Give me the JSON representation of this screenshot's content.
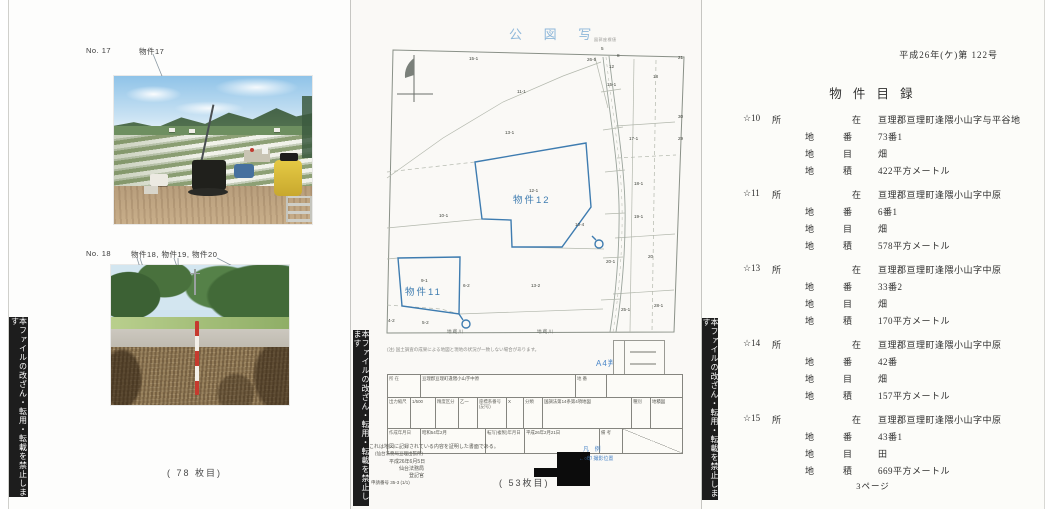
{
  "banner_text": "本ファイルの改ざん・転用・転載を禁止します",
  "photo_page": {
    "label1_no": "No. 17",
    "label1_items": "物件17",
    "label2_no": "No. 18",
    "label2_items": "物件18,  物件19, 物件20",
    "sheet_note": "(  78  枚目)"
  },
  "map_page": {
    "title": "公 図 写",
    "coord_note": "図郭座標値",
    "a4_note": "A4判に縮小",
    "parcel12_label": "物件12",
    "parcel11_label": "物件11",
    "parcels": [
      {
        "t": "15-1",
        "x": 118,
        "y": 56
      },
      {
        "t": "11-1",
        "x": 166,
        "y": 89
      },
      {
        "t": "13-1",
        "x": 154,
        "y": 130
      },
      {
        "t": "26-5",
        "x": 236,
        "y": 57
      },
      {
        "t": "5",
        "x": 250,
        "y": 46
      },
      {
        "t": "8",
        "x": 266,
        "y": 53
      },
      {
        "t": "12",
        "x": 258,
        "y": 64
      },
      {
        "t": "15-1",
        "x": 256,
        "y": 82
      },
      {
        "t": "18",
        "x": 302,
        "y": 74
      },
      {
        "t": "17-1",
        "x": 278,
        "y": 136
      },
      {
        "t": "12-1",
        "x": 178,
        "y": 188
      },
      {
        "t": "10-1",
        "x": 88,
        "y": 213
      },
      {
        "t": "10-4",
        "x": 224,
        "y": 222
      },
      {
        "t": "18-1",
        "x": 283,
        "y": 181
      },
      {
        "t": "19-1",
        "x": 283,
        "y": 214
      },
      {
        "t": "20",
        "x": 297,
        "y": 254
      },
      {
        "t": "20-1",
        "x": 255,
        "y": 259
      },
      {
        "t": "9-1",
        "x": 70,
        "y": 278
      },
      {
        "t": "13-2",
        "x": 180,
        "y": 283
      },
      {
        "t": "6-2",
        "x": 112,
        "y": 283
      },
      {
        "t": "25-1",
        "x": 270,
        "y": 307
      },
      {
        "t": "28-1",
        "x": 303,
        "y": 303
      },
      {
        "t": "4-2",
        "x": 37,
        "y": 318
      },
      {
        "t": "5-2",
        "x": 71,
        "y": 320
      }
    ],
    "edge_ticks": [
      {
        "t": "21",
        "x": 327,
        "y": 55
      },
      {
        "t": "30",
        "x": 327,
        "y": 114
      },
      {
        "t": "29",
        "x": 327,
        "y": 136
      }
    ],
    "road_labels": [
      {
        "t": "地蔵川",
        "x": 96,
        "y": 329
      },
      {
        "t": "地蔵川",
        "x": 186,
        "y": 329
      }
    ],
    "note_line": "(注) 国土調査の成果による地図と現地の状況が一致しない場合があります。",
    "table": {
      "r1c1": "所 在",
      "r1v1": "亘理郡亘理町逢隈小山字中原",
      "r1c2": "地 番",
      "r1v2": "",
      "r2c1": "出力縮尺",
      "r2v1": "1/500",
      "r2c2": "精度区分",
      "r2v2": "乙一",
      "r2c3": "座標系番号(記号)",
      "r2v3": "X",
      "r2c4": "分類",
      "r2v4": "国調法第14条第4項地図",
      "r2c5": "種別",
      "r2v5": "地積図",
      "r3c1": "作成年月日",
      "r3v1": "昭和54年2月",
      "r3c2": "転写(複製)年月日",
      "r3v2": "平成26年2月21日",
      "r3c3": "備 考"
    },
    "cert_line1": "これは地図に記録されている内容を証明した書面である。",
    "cert_line2": "(仙台法務局亘理出張所)",
    "cert_date": "平成26年6月5日",
    "cert_office": "仙台法務局",
    "cert_officer": "登記官",
    "request_no": "申請番号 35-3 (1/1)",
    "legend_title": "凡 例",
    "legend_entry": "←○印 撮影位置",
    "sheet_note": "( 53枚目)"
  },
  "list_page": {
    "case_no": "平成26年(ケ)第 122号",
    "title": "物 件 目 録",
    "row_labels": {
      "shozai": [
        "所",
        "在"
      ],
      "chiban": [
        "地",
        "番"
      ],
      "chimoku": [
        "地",
        "目"
      ],
      "chiseki": [
        "地",
        "積"
      ]
    },
    "entries": [
      {
        "no": "☆10",
        "shozai": "亘理郡亘理町逢隈小山字与平谷地",
        "chiban": "73番1",
        "chimoku": "畑",
        "chiseki": "422平方メートル"
      },
      {
        "no": "☆11",
        "shozai": "亘理郡亘理町逢隈小山字中原",
        "chiban": "6番1",
        "chimoku": "畑",
        "chiseki": "578平方メートル"
      },
      {
        "no": "☆13",
        "shozai": "亘理郡亘理町逢隈小山字中原",
        "chiban": "33番2",
        "chimoku": "畑",
        "chiseki": "170平方メートル"
      },
      {
        "no": "☆14",
        "shozai": "亘理郡亘理町逢隈小山字中原",
        "chiban": "42番",
        "chimoku": "畑",
        "chiseki": "157平方メートル"
      },
      {
        "no": "☆15",
        "shozai": "亘理郡亘理町逢隈小山字中原",
        "chiban": "43番1",
        "chimoku": "田",
        "chiseki": "669平方メートル"
      }
    ],
    "page_footer": "3ページ"
  }
}
